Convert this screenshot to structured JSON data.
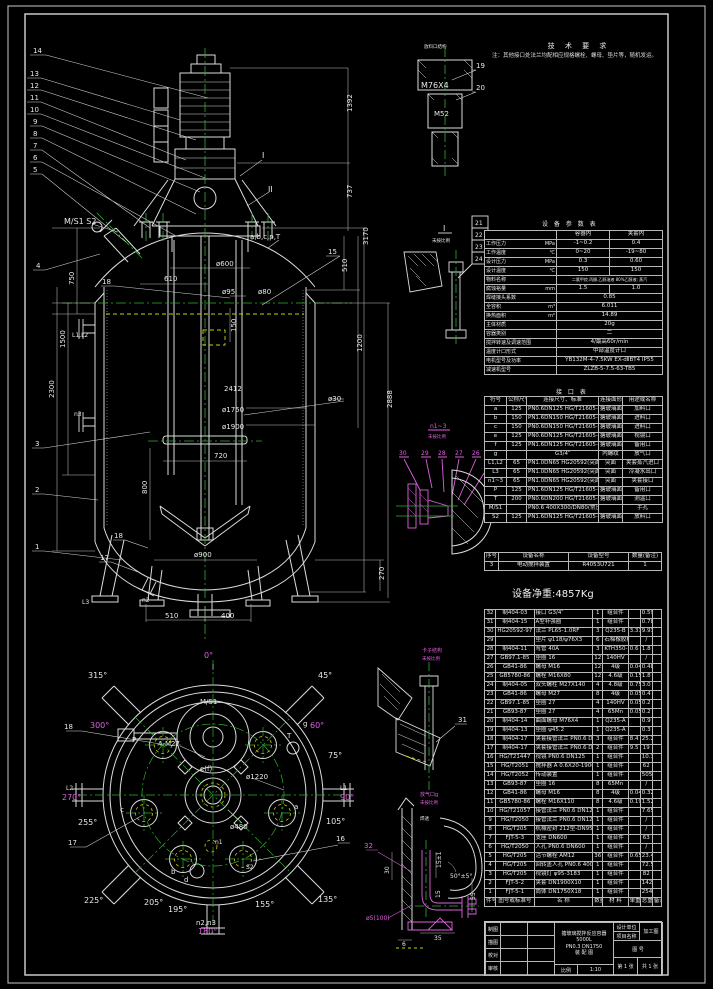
{
  "tech": {
    "title": "技 术 要 求",
    "items": [
      "1.本设备按GB150-1998《钢制压力容器》和HG2432-2001《搪玻璃设备技术条件》进行制造、检验和验收，并接受《压力容器安全技术监察规程》的监督检查。",
      "2.焊接采用手工电弧焊接，手工焊条牌号J422；埋弧焊焊丝H08A，焊剂GJ301。",
      "3.焊接接头型式除注明外，按HG20583-1997《钢制化工容器结构设计规定》中规定，内外封头均采用全焊透结构；接管与壳体焊接采用D2型；法兰与接管的焊接按相应法兰标准规定执行。",
      "4.容器上封头A、B类焊接接头处作磁粉检测（渗透检测），其检测长度不得少于各条焊接接头长度的20%，且不小于250mm，按JB4730-2005《承压设备无损检测》Ⅱ级为合格。",
      "5.容器水压试验压力0.40MPa（卧置试压），夹套水压试验压力0.75MPa（卧置试压合格）。",
      "6.石棉垫片等易潮材料应妥善保管防水防潮，不得在不合格部位进行装配施工。",
      "7.0.8*2.0mm,20KV,.",
      "8.搪玻璃面涂漆 兰色（按相应厂标d）。",
      "9.设计及文件上未注明事项，按相应国家及行业标准执行。",
      "10.设备外表面除锈后涂刷两遍铁红防锈漆。"
    ],
    "note": "注：其他接口处法兰均配相应规格螺栓、螺母、垫片等，随机发运。"
  },
  "params": {
    "title": "设 备 参 数 表",
    "h1": "容器内",
    "h2": "夹套内",
    "r1": {
      "l": "工作压力",
      "u": "MPa",
      "a": "-1~0.2",
      "b": "0.4"
    },
    "r2": {
      "l": "工作温度",
      "u": "℃",
      "a": "0~20",
      "b": "-19~80"
    },
    "r3": {
      "l": "设计压力",
      "u": "MPa",
      "a": "0.3",
      "b": "0.60"
    },
    "r4": {
      "l": "设计温度",
      "u": "℃",
      "a": "150",
      "b": "150"
    },
    "r5": {
      "l": "物料名称",
      "u": "",
      "s": "二氯甲烷.丙酮.乙醇溶液 80%乙醇液; 蒸汽"
    },
    "r6": {
      "l": "腐蚀裕量",
      "u": "mm",
      "a": "1.5",
      "b": "1.0"
    },
    "r7": {
      "l": "焊缝接头系数",
      "u": "",
      "s": "0.85"
    },
    "r8": {
      "l": "全容积",
      "u": "m³",
      "s": "6.011"
    },
    "r9": {
      "l": "换热面积",
      "u": "m²",
      "s": "14.89"
    },
    "r10": {
      "l": "主体材质",
      "u": "",
      "s": "20g"
    },
    "r11": {
      "l": "容器类别",
      "u": "",
      "s": "二"
    },
    "r12": {
      "l": "搅拌转速及调速范围",
      "u": "",
      "s": "4/最高60r/min"
    },
    "r13": {
      "l": "温度计口形式",
      "u": "",
      "s": "中部温度计口"
    },
    "r14": {
      "l": "电机型号及功率",
      "u": "",
      "s": "YB132M-4-7.5KW EX-dⅡBT4 IP55"
    },
    "r15": {
      "l": "减速机型号",
      "u": "",
      "s": "ZLZB-5-7.5-63-TB5"
    }
  },
  "nozzles": {
    "title": "接 口 表",
    "headers": [
      "符号",
      "公称尺寸",
      "连接尺寸、标准",
      "连接面形式",
      "用途或名称"
    ],
    "rows": [
      {
        "sym": "a",
        "dn": "125",
        "std": "PN0.6DN125 HG/T21605-91",
        "face": "搪玻璃面",
        "use": "加料口"
      },
      {
        "sym": "b",
        "dn": "150",
        "std": "PN1.6DN150 HG/T21605-91",
        "face": "搪玻璃面",
        "use": "进料口"
      },
      {
        "sym": "c",
        "dn": "150",
        "std": "PN0.6DN150 HG/T21605-91",
        "face": "搪玻璃面",
        "use": "进料口"
      },
      {
        "sym": "e",
        "dn": "125",
        "std": "PN0.6DN125 HG/T21605-91",
        "face": "搪玻璃面",
        "use": "视镜口"
      },
      {
        "sym": "f",
        "dn": "125",
        "std": "PN1.6DN125 HG/T21605-91",
        "face": "搪玻璃面",
        "use": "备用口"
      },
      {
        "sym": "g",
        "dn": "",
        "std": "G3/4″",
        "face": "内螺纹",
        "use": "放气口"
      },
      {
        "sym": "L1,L2",
        "dn": "65",
        "std": "PN1.0DN65 HG20592(突面RF)",
        "face": "突面",
        "use": "夹套蒸汽进口"
      },
      {
        "sym": "L3",
        "dn": "65",
        "std": "PN1.0DN65 HG20592(突面RF)",
        "face": "突面",
        "use": "冷凝水出口"
      },
      {
        "sym": "n1~3",
        "dn": "65",
        "std": "PN1.0DN65 HG20592(突面RF)",
        "face": "突面",
        "use": "夹套接口"
      },
      {
        "sym": "P",
        "dn": "125",
        "std": "PN1.6DN125 HG/T21605-91",
        "face": "搪玻璃面",
        "use": "备用口"
      },
      {
        "sym": "T",
        "dn": "200",
        "std": "PN0.6DN200 HG/T21605-91",
        "face": "搪玻璃面",
        "use": "测温口"
      },
      {
        "sym": "M/S1",
        "dn": "",
        "std": "PN0.6 400X300/DN80(常压)",
        "face": "",
        "use": "手孔"
      },
      {
        "sym": "S2",
        "dn": "125",
        "std": "PN1.6DN125 HG/T21605-91",
        "face": "搪玻璃面",
        "use": "放料口"
      }
    ]
  },
  "device_table": {
    "headers": [
      "序号",
      "设备名称",
      "设备型号",
      "数量(备注)"
    ],
    "rows": [
      {
        "no": "3",
        "name": "电动搅拌装置",
        "model": "R4053U721",
        "qty": "1"
      }
    ]
  },
  "weight_note": "设备净重:4857Kg",
  "bom": {
    "h0": "件号",
    "h1": "图号或标准号",
    "h2": "名  称",
    "h3": "数量",
    "h4": "材  料",
    "h5": "单重",
    "h6": "总重",
    "h7": "备注",
    "rows": [
      {
        "no": "32",
        "code": "制404-03",
        "name": "接口 G3/4″",
        "qty": "1",
        "mat": "组合件",
        "w1": "",
        "w2": "0.59",
        "rmk": ""
      },
      {
        "no": "31",
        "code": "制404-15",
        "name": "A型补强圈",
        "qty": "1",
        "mat": "组合件",
        "w1": "",
        "w2": "0.78",
        "rmk": ""
      },
      {
        "no": "30",
        "code": "HG20592-97",
        "name": "法兰 PL65-1.0RF",
        "qty": "3",
        "mat": "Q235-B",
        "w1": "3.31",
        "w2": "9.93",
        "rmk": ""
      },
      {
        "no": "29",
        "code": "",
        "name": "垫片 ψ118/ψ76X3",
        "qty": "6",
        "mat": "石棉橡胶板",
        "w1": "",
        "w2": "/",
        "rmk": ""
      },
      {
        "no": "28",
        "code": "制404-11",
        "name": "弯管 40A",
        "qty": "3",
        "mat": "KTH350-10",
        "w1": "0.6",
        "w2": "1.8",
        "rmk": ""
      },
      {
        "no": "27",
        "code": "GB97.1-85",
        "name": "垫圈 16",
        "qty": "12",
        "mat": "140HV",
        "w1": "",
        "w2": "/",
        "rmk": ""
      },
      {
        "no": "26",
        "code": "GB41-86",
        "name": "螺母 M16",
        "qty": "12",
        "mat": "4级",
        "w1": "0.04",
        "w2": "0.48",
        "rmk": ""
      },
      {
        "no": "25",
        "code": "GB5780-86",
        "name": "螺栓 M16X80",
        "qty": "12",
        "mat": "4.6级",
        "w1": "0.15",
        "w2": "1.8",
        "rmk": ""
      },
      {
        "no": "24",
        "code": "制404-05",
        "name": "双头螺柱 M27X140",
        "qty": "4",
        "mat": "4.8级",
        "w1": "0.75",
        "w2": "3.0",
        "rmk": ""
      },
      {
        "no": "23",
        "code": "GB41-86",
        "name": "螺母 M27",
        "qty": "8",
        "mat": "4级",
        "w1": "0.05",
        "w2": "0.4",
        "rmk": ""
      },
      {
        "no": "22",
        "code": "GB97.1-85",
        "name": "垫圈 27",
        "qty": "4",
        "mat": "140HV",
        "w1": "0.05",
        "w2": "0.2",
        "rmk": ""
      },
      {
        "no": "21",
        "code": "GB93-87",
        "name": "垫圈 27",
        "qty": "4",
        "mat": "65Mn",
        "w1": "0.05",
        "w2": "0.2",
        "rmk": ""
      },
      {
        "no": "20",
        "code": "制404-14",
        "name": "曲面螺母 M76X4",
        "qty": "1",
        "mat": "Q235-A",
        "w1": "",
        "w2": "0.9",
        "rmk": ""
      },
      {
        "no": "19",
        "code": "制404-13",
        "name": "垫圈 ψ45.2",
        "qty": "1",
        "mat": "Q235-A",
        "w1": "",
        "w2": "0.3",
        "rmk": ""
      },
      {
        "no": "18",
        "code": "制404-17",
        "name": "夹套接管法兰 PN0.6 DN125",
        "qty": "3",
        "mat": "组合件",
        "w1": "8.4",
        "w2": "25.2",
        "rmk": ""
      },
      {
        "no": "17",
        "code": "制404-17",
        "name": "夹套接管法兰 PN0.6 DN150",
        "qty": "2",
        "mat": "组合件",
        "w1": "9.5",
        "w2": "19",
        "rmk": ""
      },
      {
        "no": "16",
        "code": "HG/T21447",
        "name": "视镜 PN0.6 DN125",
        "qty": "1",
        "mat": "组合件",
        "w1": "",
        "w2": "10.3",
        "rmk": ""
      },
      {
        "no": "15",
        "code": "HG/T2051",
        "name": "搅拌器 A 0.6X20-1900",
        "qty": "1",
        "mat": "组合件",
        "w1": "",
        "w2": "62",
        "rmk": ""
      },
      {
        "no": "14",
        "code": "HG/T2052",
        "name": "传动装置",
        "qty": "1",
        "mat": "组合件",
        "w1": "",
        "w2": "505",
        "rmk": ""
      },
      {
        "no": "13",
        "code": "GB93-87",
        "name": "垫圈 16",
        "qty": "8",
        "mat": "65Mn",
        "w1": "",
        "w2": "/",
        "rmk": ""
      },
      {
        "no": "12",
        "code": "GB41-86",
        "name": "螺母 M16",
        "qty": "8",
        "mat": "4级",
        "w1": "0.04",
        "w2": "0.32",
        "rmk": ""
      },
      {
        "no": "11",
        "code": "GB5780-86",
        "name": "螺栓 M16X110",
        "qty": "8",
        "mat": "4.6级",
        "w1": "0.19",
        "w2": "1.52",
        "rmk": ""
      },
      {
        "no": "10",
        "code": "HG/T21057",
        "name": "接管法兰 PN0.6 DN125",
        "qty": "1",
        "mat": "组合件",
        "w1": "",
        "w2": "7.65",
        "rmk": ""
      },
      {
        "no": "9",
        "code": "HG/T2050",
        "name": "接管法兰 PN0.6 DN125",
        "qty": "1",
        "mat": "组合件",
        "w1": "",
        "w2": "/",
        "rmk": ""
      },
      {
        "no": "8",
        "code": "HG/T205",
        "name": "机械密封 212型-DN95",
        "qty": "1",
        "mat": "组合件",
        "w1": "",
        "w2": "/",
        "rmk": ""
      },
      {
        "no": "7",
        "code": "FJT-5-3",
        "name": "支座 DN600",
        "qty": "1",
        "mat": "组合件",
        "w1": "",
        "w2": "63",
        "rmk": ""
      },
      {
        "no": "6",
        "code": "HG/T2050",
        "name": "人孔 PN0.6 DN600",
        "qty": "1",
        "mat": "组合件",
        "w1": "",
        "w2": "/",
        "rmk": ""
      },
      {
        "no": "5",
        "code": "HG/T205",
        "name": "活节螺栓 AM12",
        "qty": "36",
        "mat": "组合件",
        "w1": "0.65",
        "w2": "23.4",
        "rmk": ""
      },
      {
        "no": "4",
        "code": "HG/T205",
        "name": "回转盖人孔 PN0.6 400X300",
        "qty": "1",
        "mat": "组合件",
        "w1": "",
        "w2": "72.5",
        "rmk": ""
      },
      {
        "no": "3",
        "code": "HG/T205",
        "name": "视镜灯 ψ95-3183",
        "qty": "1",
        "mat": "组合件",
        "w1": "",
        "w2": "82",
        "rmk": ""
      },
      {
        "no": "2",
        "code": "FJT-5-2",
        "name": "夹套 DN1900X10",
        "qty": "1",
        "mat": "组合件",
        "w1": "",
        "w2": "1422",
        "rmk": ""
      },
      {
        "no": "1",
        "code": "FJT-5-1",
        "name": "筒体 DN1750X18",
        "qty": "1",
        "mat": "组合件",
        "w1": "",
        "w2": "2549",
        "rmk": ""
      }
    ]
  },
  "title_block": {
    "product_line1": "搪玻璃搅拌反应容器 5000L",
    "product_line2": "PN0.3 DN1750",
    "product_line3": "装 配 图",
    "scale_label": "比例",
    "scale": "1:10",
    "row_a": "制图",
    "row_b": "描图",
    "row_c": "校对",
    "row_d": "审核",
    "right_top1": "设计单位",
    "right_tag": "加工图",
    "right_top2": "项目名称",
    "right_mid": "图  号",
    "sheet": "第 1 张",
    "sheets": "共 1 张"
  },
  "fv": {
    "b14": "14",
    "b13": "13",
    "b12": "12",
    "b11": "11",
    "b10": "10",
    "b9": "9",
    "b8": "8",
    "b7": "7",
    "b6": "6",
    "b5": "5",
    "b4": "4",
    "b3": "3",
    "b2": "2",
    "b1": "1",
    "b15": "15",
    "b18": "18",
    "b18b": "18",
    "b17": "17",
    "sec1": "I",
    "sec2": "II",
    "ms1s2": "M/S1 S2",
    "abcpt": "a,b,c,p,T",
    "d1392": "1392",
    "d737": "737",
    "d3170": "3170",
    "d510": "510",
    "d1200": "1200",
    "d2888": "2888",
    "d2412": "2412",
    "d270": "270",
    "d610": "610",
    "d600": "ø600",
    "d95": "ø95",
    "d80": "ø80",
    "d150": "150",
    "d1750": "ø1750",
    "d1900": "ø1900",
    "d720": "720",
    "d800": "800",
    "d900": "ø900",
    "d510b": "510",
    "d400": "400",
    "d750": "750",
    "d1500": "1500",
    "d2300": "2300",
    "d30": "ø30",
    "l12": "L1,L2",
    "n3": "n3",
    "n2": "n2",
    "l3": "L3"
  },
  "pv": {
    "a0": "0°",
    "a45": "45°",
    "a60": "60°",
    "a75": "75°",
    "a90": "90°",
    "a105": "105°",
    "a135": "135°",
    "a155": "155°",
    "a180": "180°",
    "a195": "195°",
    "a205": "205°",
    "a225": "225°",
    "a255": "255°",
    "a270": "270°",
    "a300": "300°",
    "a315": "315°",
    "ms1": "M/S1",
    "m27": "4-M27",
    "d1220": "ø1220",
    "d480": "ø480",
    "ef": "e(f)",
    "n1": "n1",
    "s2": "S2",
    "t": "T",
    "p": "P",
    "a": "a",
    "b": "b",
    "c": "c",
    "d": "d",
    "g": "g",
    "n23": "n2,n3",
    "b18": "18",
    "b17": "17",
    "b16": "16",
    "lL1": "L1",
    "lL2": "L2"
  },
  "det": {
    "cap_title": "放料口结构",
    "m76": "M76X4",
    "m52": "M52",
    "b19": "19",
    "b20": "20",
    "di_t": "I",
    "di_s": "未按比例",
    "b21": "21",
    "b22": "22",
    "b23": "23",
    "b24": "24",
    "n13_t": "n1~3",
    "n13_s": "未按比例",
    "b25": "25",
    "b26": "26",
    "b27": "27",
    "b28": "28",
    "b29": "29",
    "b30": "30",
    "n13_note": "搪玻璃测温套管",
    "cl_t": "卡子结构",
    "cl_s": "未按比例",
    "b31": "31",
    "g_t": "放气口g",
    "g_s": "未按比例",
    "b32": "32",
    "g30": "30",
    "g15a": "15±1",
    "g50": "50°±5°",
    "g15": "15",
    "g55": "55",
    "g35": "35",
    "g6": "6",
    "g5": "ø5(100)",
    "gweld": "焊透"
  }
}
